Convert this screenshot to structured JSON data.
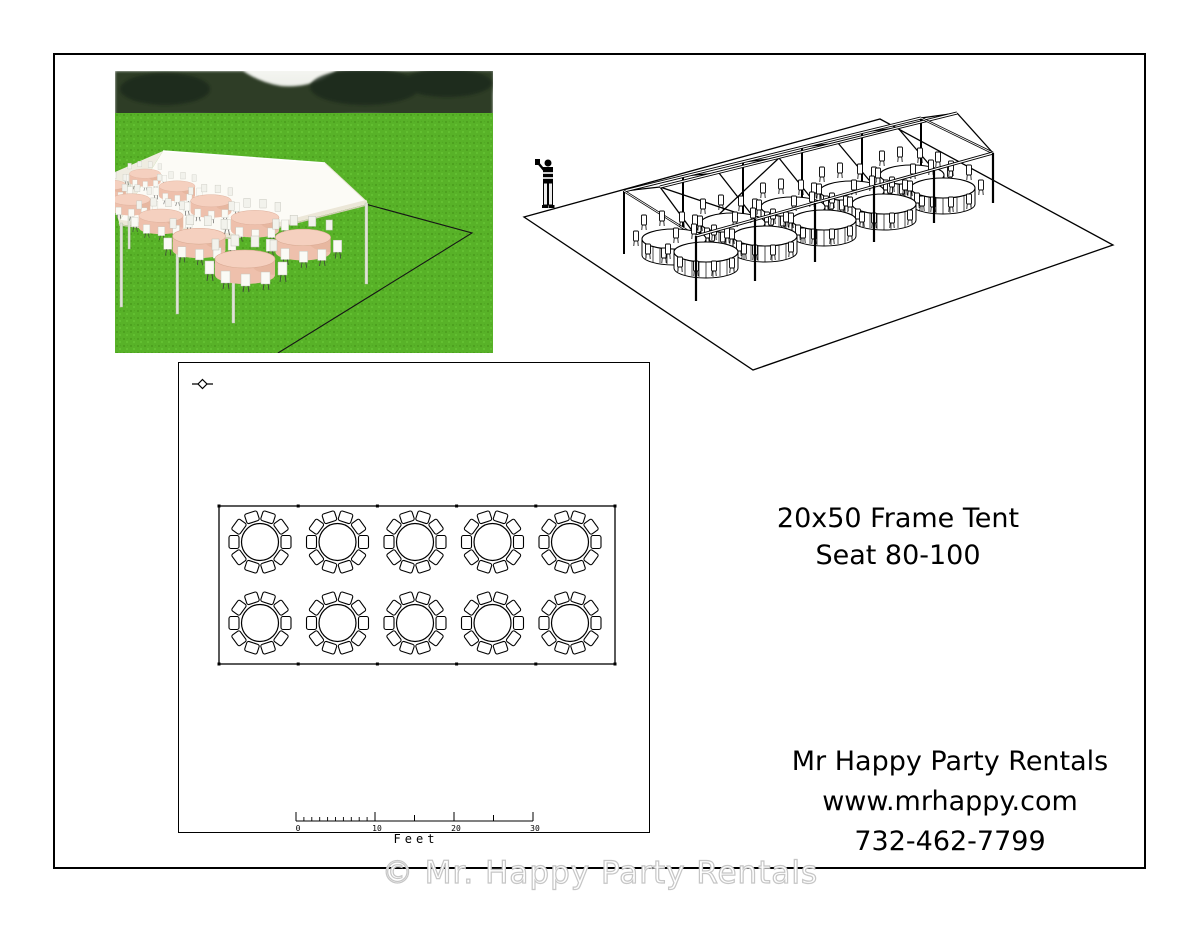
{
  "title_block": {
    "line1": "20x50 Frame Tent",
    "line2": "Seat 80-100"
  },
  "contact_block": {
    "company": "Mr Happy Party Rentals",
    "website": "www.mrhappy.com",
    "phone": "732-462-7799"
  },
  "watermark": {
    "text": "© Mr. Happy Party Rentals"
  },
  "floor_plan": {
    "scale_bar": {
      "labels": [
        "0",
        "10",
        "20",
        "30"
      ],
      "unit": "Feet"
    },
    "layout": {
      "tables": 10,
      "rows": 2,
      "columns": 5,
      "chairs_per_table": 10
    }
  },
  "colors": {
    "grass": "#58b228",
    "trees": "#2f3d28",
    "canopy": "#fcfbf6",
    "tablecloth": "#eec0ac",
    "drawing_line": "#000000",
    "watermark_fill": "#ffffff",
    "watermark_outline": "#c6c6c6"
  }
}
